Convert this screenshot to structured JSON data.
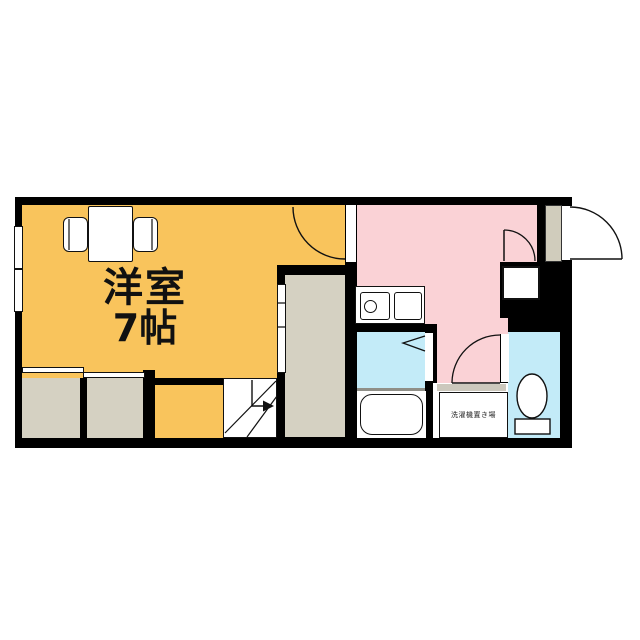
{
  "plan": {
    "room_name": "洋室",
    "room_size": "7帖",
    "laundry_label": "洗濯機置き場",
    "colors": {
      "orange": "#F9C45C",
      "pink": "#FAD2D6",
      "cyan": "#C3EBF8",
      "grey": "#D5D1C2",
      "black": "#000000"
    }
  }
}
